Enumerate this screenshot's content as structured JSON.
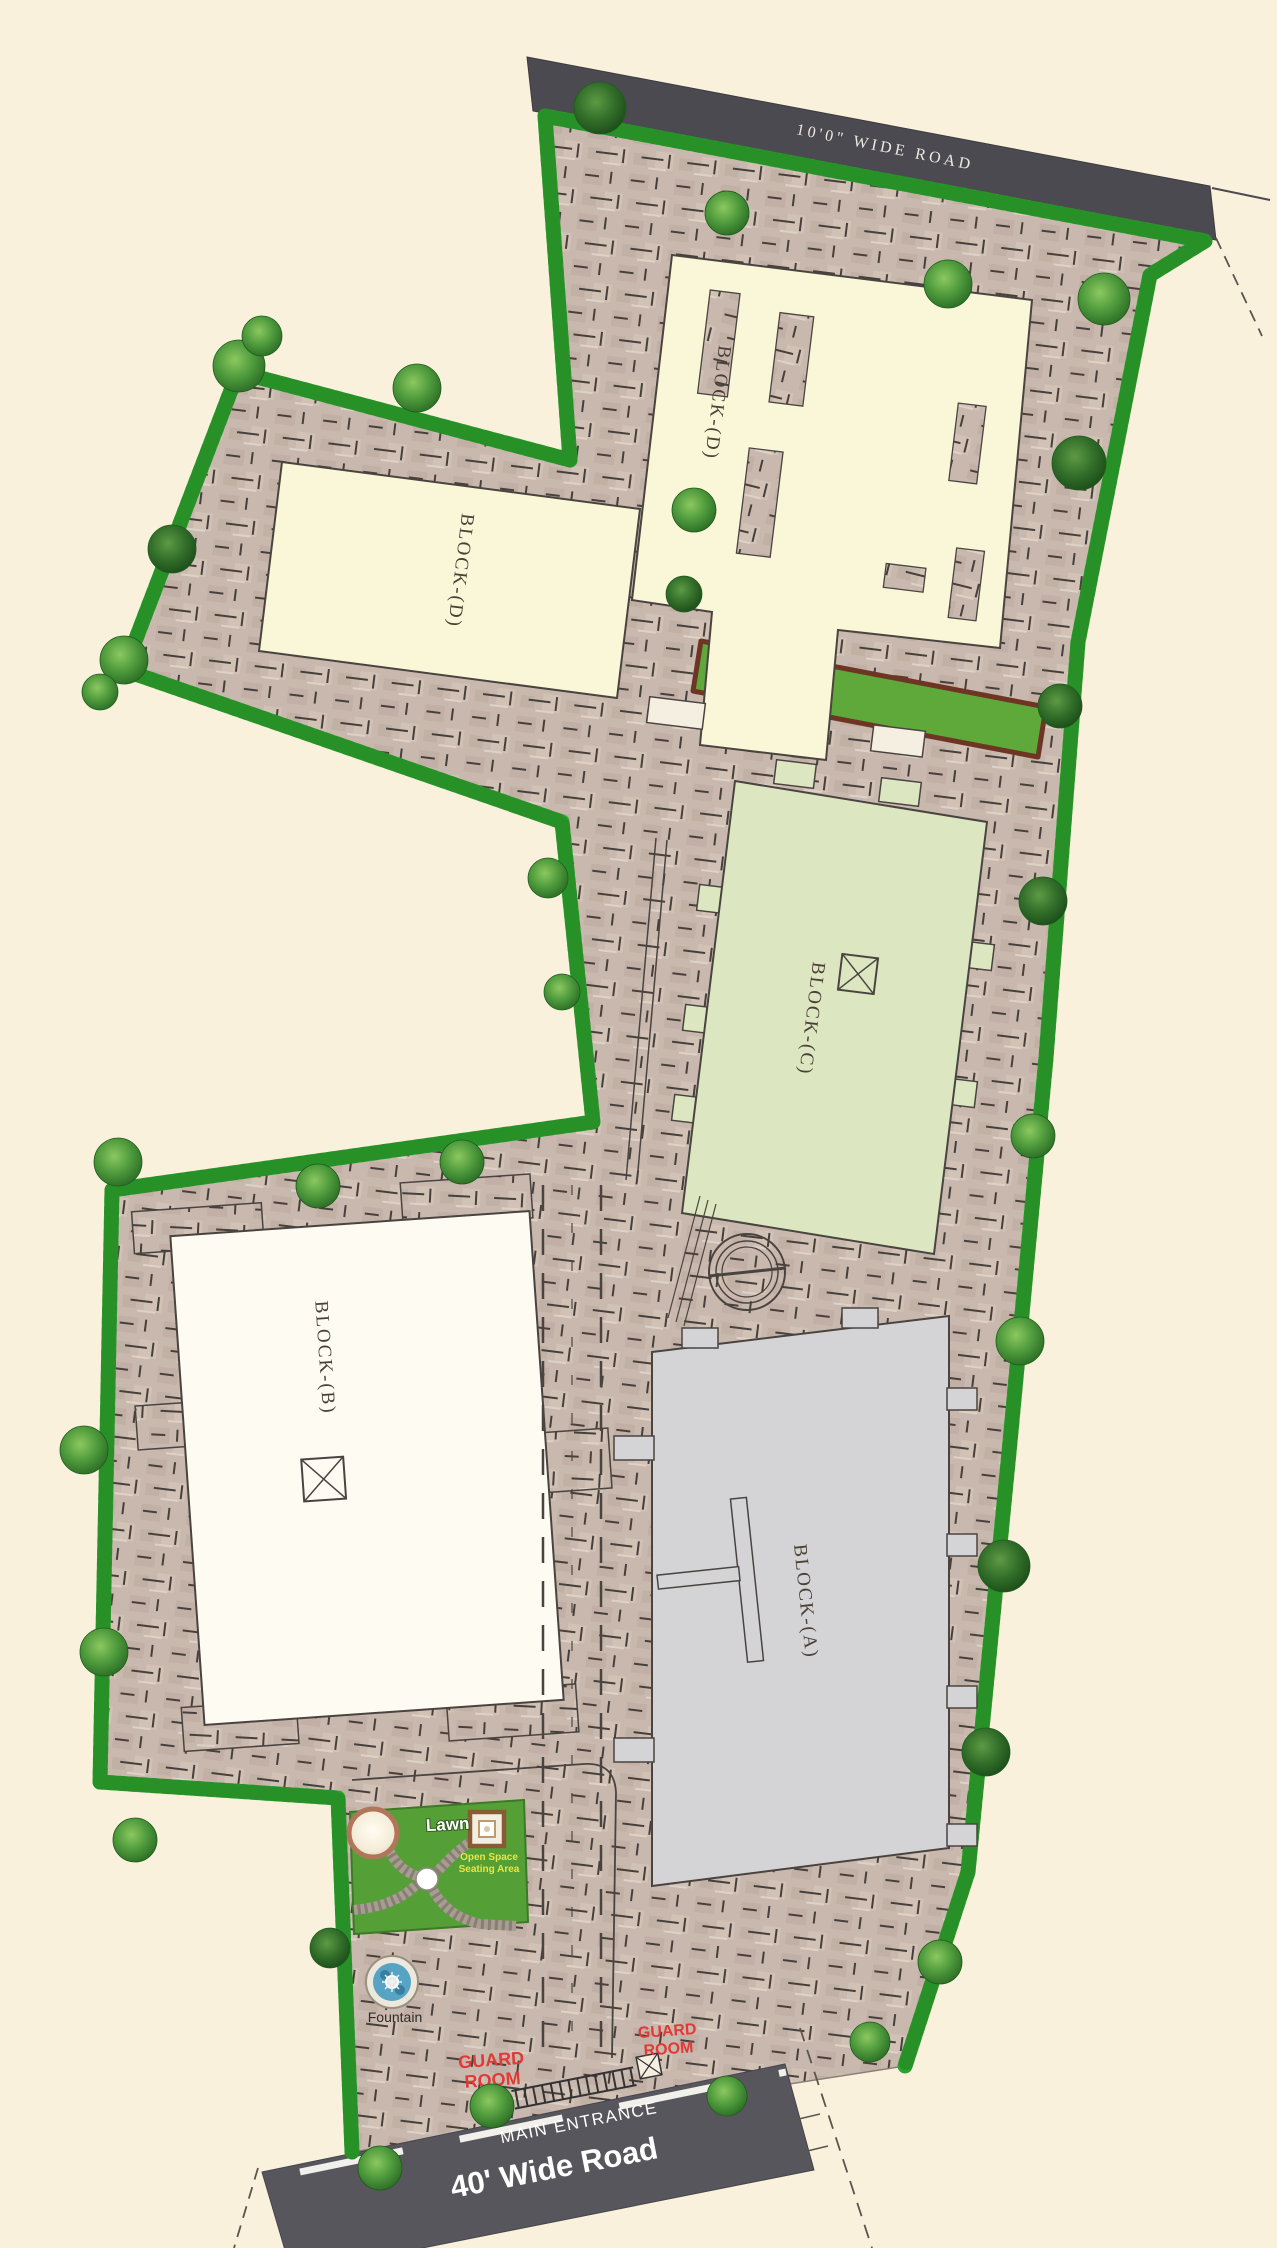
{
  "plan": {
    "type": "residential site layout plan",
    "roads": {
      "top": {
        "label": "10'0\" WIDE ROAD"
      },
      "bottom": {
        "label": "40' Wide Road",
        "entrance_label": "MAIN ENTRANCE"
      }
    },
    "blocks": {
      "d_upper": {
        "label": "BLOCK-(D)"
      },
      "d_lower": {
        "label": "BLOCK-(D)"
      },
      "c": {
        "label": "BLOCK-(C)"
      },
      "b": {
        "label": "BLOCK-(B)"
      },
      "a": {
        "label": "BLOCK-(A)"
      }
    },
    "amenities": {
      "lawn_label": "Lawn",
      "open_space_line1": "Open Space",
      "open_space_line2": "Seating Area",
      "fountain_label": "Fountain"
    },
    "guard_rooms": {
      "left": {
        "line1": "GUARD",
        "line2": "ROOM"
      },
      "right": {
        "line1": "GUARD",
        "line2": "ROOM"
      }
    },
    "colors": {
      "background": "#FAF1DD",
      "road": "#4B4A50",
      "paving": "#C9B8AE",
      "hedge": "#2EA22E",
      "lawn": "#55A036",
      "block_d": "#FAF6D8",
      "block_c": "#DCE7C2",
      "block_b": "#FDFBF2",
      "block_a": "#D4D4D6",
      "guard_text": "#E03A36",
      "fountain_water": "#57A3C4"
    }
  }
}
